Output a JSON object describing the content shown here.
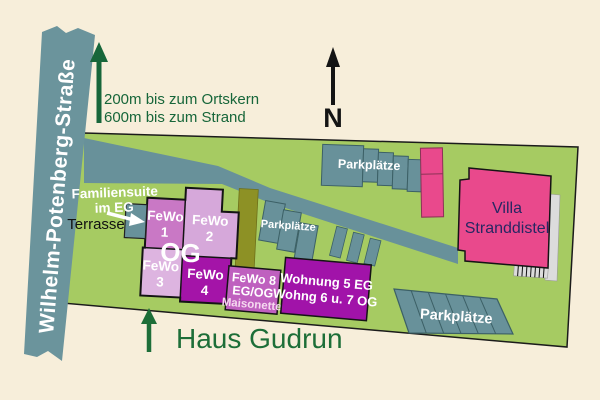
{
  "street": {
    "label": "Wilhelm-Potenberg-Straße"
  },
  "directions": {
    "line1": "200m bis zum Ortskern",
    "line2": "600m bis zum Strand"
  },
  "compass": {
    "label": "N"
  },
  "site": {
    "name": "Haus Gudrun"
  },
  "building": {
    "floor": "OG",
    "suite": {
      "line1": "Familiensuite",
      "line2": "im EG"
    },
    "terrace": "Terrasse",
    "units": [
      {
        "name": "FeWo",
        "num": "1"
      },
      {
        "name": "FeWo",
        "num": "2"
      },
      {
        "name": "FeWo",
        "num": "3"
      },
      {
        "name": "FeWo",
        "num": "4"
      }
    ]
  },
  "fewo8": {
    "line1": "FeWo 8",
    "line2": "EG/OG",
    "line3": "Maisonette"
  },
  "wohnung5": {
    "line1": "Wohnung 5 EG",
    "line2": "Wohng 6 u. 7 OG"
  },
  "villa": {
    "line1": "Villa",
    "line2": "Stranddistel"
  },
  "parking": {
    "top": "Parkplätze",
    "middle": "Parkplätze",
    "bottom": "Parkplätze"
  },
  "colors": {
    "background": "#f7eeda",
    "street_teal": "#6b949c",
    "paving_teal": "#68919a",
    "site_green": "#a6cb62",
    "accent_green": "#17663a",
    "fewo1": "#c978c5",
    "fewo2": "#d6a8da",
    "fewo3": "#ddb4e0",
    "fewo4": "#a414a8",
    "fewo8": "#bf60bf",
    "wohnung5": "#a113a9",
    "villa_pink": "#e9498c",
    "olive": "#8d9125",
    "villa_text": "#272763"
  }
}
